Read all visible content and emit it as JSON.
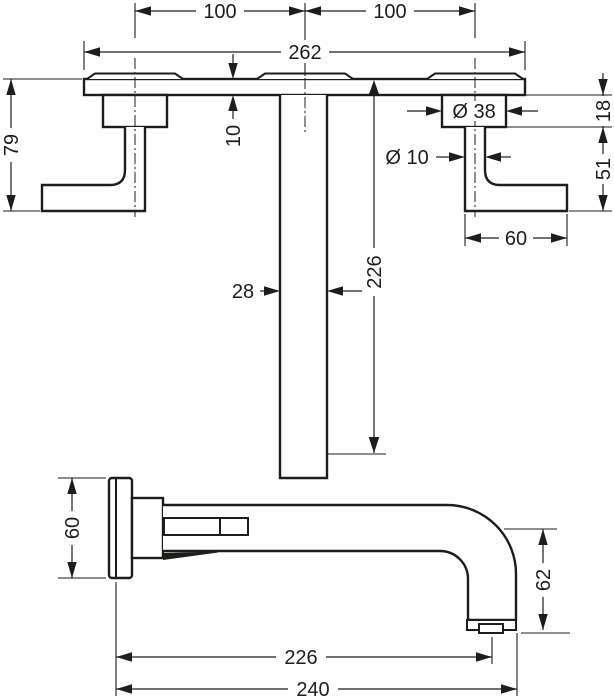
{
  "drawing": {
    "kind": "technical dimension drawing",
    "subject": "wall-mounted 3-hole basin mixer (plan view and side view)",
    "units": "mm",
    "ink_color": "#1d1d1b",
    "background_color": "#ffffff"
  },
  "dimensions": {
    "top_view": {
      "handle_spacing_left": "100",
      "handle_spacing_right": "100",
      "plate_width": "262",
      "handle_projection": "79",
      "plate_thickness": "10",
      "spout_length": "226",
      "spout_width": "28",
      "escutcheon_diameter": "Ø 38",
      "handle_stem_diameter": "Ø 10",
      "escutcheon_depth": "18",
      "handle_drop": "51",
      "handle_width": "60"
    },
    "side_view": {
      "flange_height": "60",
      "outlet_drop": "62",
      "reach_to_aerator": "226",
      "total_reach": "240"
    }
  }
}
